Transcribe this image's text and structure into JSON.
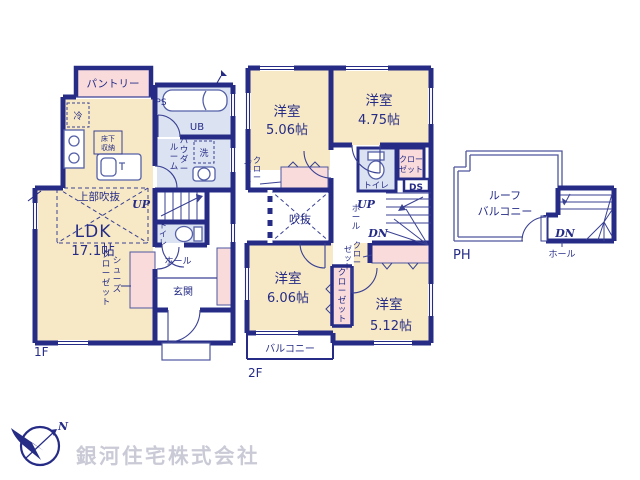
{
  "colors": {
    "wall": "#262c86",
    "cream": "#f7e9c5",
    "pink": "#f9dbdc",
    "blue": "#dbe3f3",
    "gray": "#c9cad6"
  },
  "f1": {
    "floor": "1F",
    "pantry": "パントリー",
    "ps": "PS",
    "ub": "UB",
    "wash": "洗",
    "powder1": "パウダー",
    "powder2": "ルーム",
    "fridge": "冷",
    "underfloor1": "床下",
    "underfloor2": "収納",
    "voidupper": "上部吹抜",
    "ldk": "LDK",
    "ldk_size": "17.1帖",
    "up": "UP",
    "toilet": "トイレ",
    "hall": "ホール",
    "entrance": "玄関",
    "shoes1": "シューズ",
    "shoes2": "クローゼット"
  },
  "f2": {
    "floor": "2F",
    "room1": "洋室",
    "room1_size": "5.06帖",
    "room2": "洋室",
    "room2_size": "4.75帖",
    "closet_l1": "クロー",
    "closet_l2": "ゼット",
    "toilet": "トイレ",
    "closet_tr1": "クロー",
    "closet_tr2": "ゼット",
    "ds": "DS",
    "void": "吹抜",
    "up": "UP",
    "dn": "DN",
    "hall": "ホール",
    "closet_mid": "クローゼット",
    "closet_r1": "クロー",
    "closet_r2": "ゼット",
    "room3": "洋室",
    "room3_size": "6.06帖",
    "room4": "洋室",
    "room4_size": "5.12帖",
    "balcony": "バルコニー"
  },
  "ph": {
    "floor": "PH",
    "roof1": "ルーフ",
    "roof2": "バルコニー",
    "dn": "DN",
    "hall": "ホール"
  },
  "footer": {
    "company": "銀河住宅株式会社",
    "north": "N"
  }
}
